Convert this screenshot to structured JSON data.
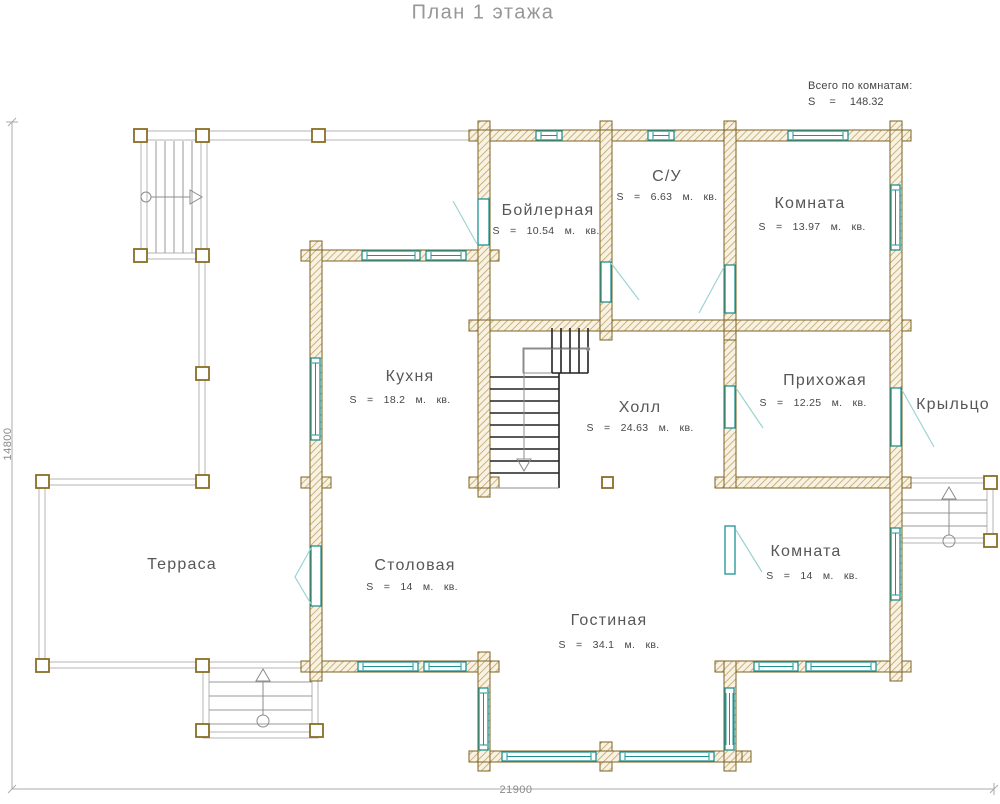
{
  "header": {
    "title": "План 1 этажа"
  },
  "summary": {
    "caption": "Всего по комнатам:",
    "total": "S = 148.32"
  },
  "rooms": {
    "boiler": {
      "name": "Бойлерная",
      "area": "S = 10.54 м. кв."
    },
    "bathroom": {
      "name": "С/У",
      "area": "S = 6.63 м. кв."
    },
    "room_top": {
      "name": "Комната",
      "area": "S = 13.97 м. кв."
    },
    "kitchen": {
      "name": "Кухня",
      "area": "S = 18.2 м. кв."
    },
    "hall": {
      "name": "Холл",
      "area": "S = 24.63 м. кв."
    },
    "entry_hall": {
      "name": "Прихожая",
      "area": "S = 12.25 м. кв."
    },
    "porch": {
      "name": "Крыльцо"
    },
    "terrace": {
      "name": "Терраса"
    },
    "dining": {
      "name": "Столовая",
      "area": "S = 14 м. кв."
    },
    "living": {
      "name": "Гостиная",
      "area": "S = 34.1 м. кв."
    },
    "room_bottom": {
      "name": "Комната",
      "area": "S = 14 м. кв."
    }
  },
  "dimensions": {
    "horizontal": "21900",
    "vertical": "14800"
  },
  "colors": {
    "wall_outline": "#7c6324",
    "wall_hatch": "#c2a35f",
    "wall_fill": "#f8f2e4",
    "window_teal": "#1e9191",
    "door_leaf": "#9cd3d3",
    "terrace_gray": "#b5b5b5",
    "text_room": "#575757",
    "text_title": "#979797"
  }
}
